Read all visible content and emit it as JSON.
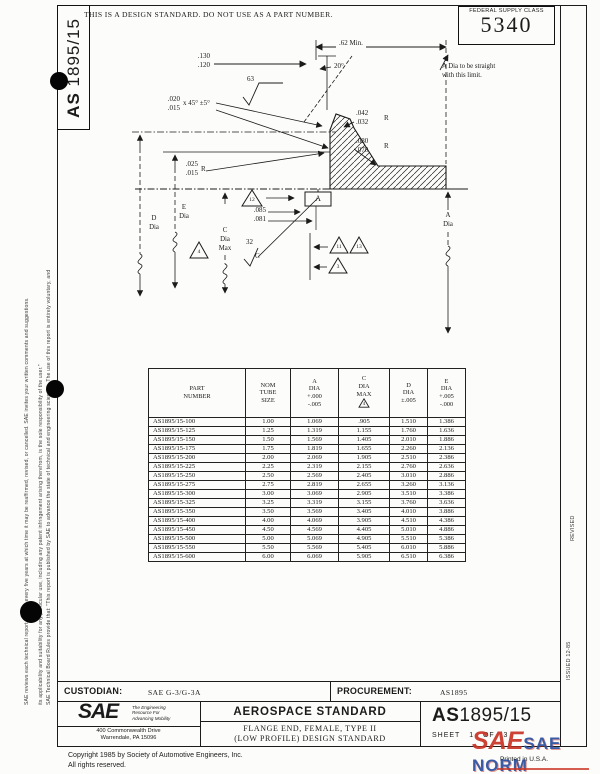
{
  "colors": {
    "ink": "#1b1b1b",
    "paper": "#fcfcfa",
    "watermark_red": "#c93425",
    "watermark_blue": "#2a4fa0"
  },
  "page": {
    "notice": "THIS IS A DESIGN STANDARD.  DO NOT USE AS A PART NUMBER.",
    "fsc_label": "FEDERAL SUPPLY CLASS",
    "fsc_value": "5340",
    "doc_prefix": "AS",
    "doc_suffix": "1895/15"
  },
  "margins": {
    "disclaimer_1": "SAE Technical Board Rules provide that: \"This report is published by SAE to advance the state of technical and engineering sciences. The use of this report is entirely voluntary, and",
    "disclaimer_2": "its applicability and suitability for any particular use, including any patent infringement arising therefrom, is the sole responsibility of the user.\"",
    "disclaimer_3": "SAE reviews each technical report at least every five years at which time it may be reaffirmed, revised, or cancelled. SAE invites your written comments and suggestions.",
    "revised": "REVISED",
    "issued": "ISSUED  12-85"
  },
  "drawing": {
    "dim_62": ".62 Min.",
    "dim_130": ".130",
    "dim_120": ".120",
    "dim_20deg": "20°",
    "finish_63": "63",
    "note_a_1": "A Dia to be straight",
    "note_a_2": "with this limit.",
    "dim_020": ".020",
    "dim_015a": ".015",
    "chamfer": "x 45° ±5°",
    "dim_042": ".042",
    "dim_032": ".032",
    "r1": "R",
    "dim_080": ".080",
    "dim_070": ".070",
    "r2": "R",
    "dim_025": ".025",
    "dim_015b": ".015",
    "r3": "R",
    "dim_085": ".085",
    "dim_081": ".081",
    "datum_a": "A",
    "flag_12": "12",
    "flag_4": "4",
    "flag_11": "11",
    "flag_13": "13",
    "flag_3": "3",
    "finish_32": "32",
    "finish_32_grade": "C",
    "d_lbl": "D",
    "d_dia": "Dia",
    "e_lbl": "E",
    "e_dia": "Dia",
    "c_lbl": "C",
    "c_dia": "Dia",
    "c_max": "Max",
    "a_lbl": "A",
    "a_dia": "Dia"
  },
  "table": {
    "col_part": [
      "PART",
      "NUMBER"
    ],
    "col_nom": [
      "NOM",
      "TUBE",
      "SIZE"
    ],
    "col_a": [
      "A",
      "DIA",
      "+.000",
      "-.005"
    ],
    "col_c": [
      "C",
      "DIA",
      "MAX"
    ],
    "col_c_flag": "4",
    "col_d": [
      "D",
      "DIA",
      "±.005"
    ],
    "col_e": [
      "E",
      "DIA",
      "+.005",
      "-.000"
    ],
    "rows": [
      [
        "AS1895/15-100",
        "1.00",
        "1.069",
        ".905",
        "1.510",
        "1.386"
      ],
      [
        "AS1895/15-125",
        "1.25",
        "1.319",
        "1.155",
        "1.760",
        "1.636"
      ],
      [
        "AS1895/15-150",
        "1.50",
        "1.569",
        "1.405",
        "2.010",
        "1.886"
      ],
      [
        "AS1895/15-175",
        "1.75",
        "1.819",
        "1.655",
        "2.260",
        "2.136"
      ],
      [
        "AS1895/15-200",
        "2.00",
        "2.069",
        "1.905",
        "2.510",
        "2.386"
      ],
      [
        "AS1895/15-225",
        "2.25",
        "2.319",
        "2.155",
        "2.760",
        "2.636"
      ],
      [
        "AS1895/15-250",
        "2.50",
        "2.569",
        "2.405",
        "3.010",
        "2.886"
      ],
      [
        "AS1895/15-275",
        "2.75",
        "2.819",
        "2.655",
        "3.260",
        "3.136"
      ],
      [
        "AS1895/15-300",
        "3.00",
        "3.069",
        "2.905",
        "3.510",
        "3.386"
      ],
      [
        "AS1895/15-325",
        "3.25",
        "3.319",
        "3.155",
        "3.760",
        "3.636"
      ],
      [
        "AS1895/15-350",
        "3.50",
        "3.569",
        "3.405",
        "4.010",
        "3.886"
      ],
      [
        "AS1895/15-400",
        "4.00",
        "4.069",
        "3.905",
        "4.510",
        "4.386"
      ],
      [
        "AS1895/15-450",
        "4.50",
        "4.569",
        "4.405",
        "5.010",
        "4.886"
      ],
      [
        "AS1895/15-500",
        "5.00",
        "5.069",
        "4.905",
        "5.510",
        "5.386"
      ],
      [
        "AS1895/15-550",
        "5.50",
        "5.569",
        "5.405",
        "6.010",
        "5.886"
      ],
      [
        "AS1895/15-600",
        "6.00",
        "6.069",
        "5.905",
        "6.510",
        "6.386"
      ]
    ]
  },
  "footer": {
    "custodian_label": "CUSTODIAN:",
    "custodian_value": "SAE G-3/G-3A",
    "procurement_label": "PROCUREMENT:",
    "procurement_value": "AS1895",
    "sae_logo": "SAE",
    "tagline_1": "The Engineering",
    "tagline_2": "Resource For",
    "tagline_3": "Advancing Mobility",
    "address_1": "400 Commonwealth Drive",
    "address_2": "Warrendale, PA 15096",
    "std_type": "AEROSPACE STANDARD",
    "title_1": "FLANGE END, FEMALE, TYPE II",
    "title_2": "(LOW PROFILE) DESIGN STANDARD",
    "doc_prefix": "AS",
    "doc_num": "1895/15",
    "sheet_label": "SHEET",
    "sheet_no": "1",
    "of_label": "OF",
    "sheet_total": "3",
    "copyright_1": "Copyright 1985 by Society of Automotive Engineers, Inc.",
    "copyright_2": "All rights reserved.",
    "printed": "Printed in U.S.A.",
    "wm_sae": "SAE",
    "wm_norm": "SAE NORM",
    "wm_sub": "INTERNATIONAL"
  }
}
